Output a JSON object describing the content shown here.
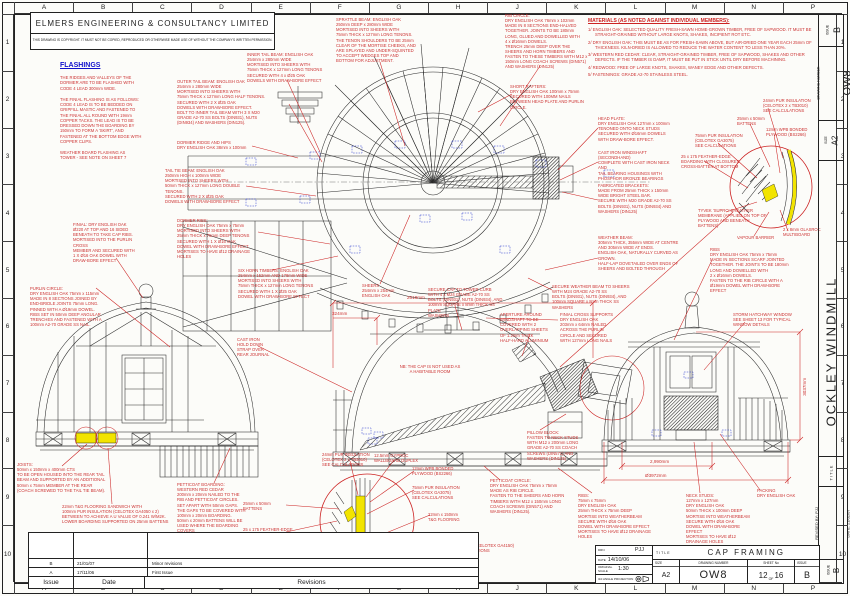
{
  "sheet": {
    "border": {
      "columns": [
        "A",
        "B",
        "C",
        "D",
        "E",
        "F",
        "G",
        "H",
        "J",
        "K",
        "L",
        "M",
        "N",
        "P"
      ],
      "rows": [
        "1",
        "2",
        "3",
        "4",
        "5",
        "6",
        "7",
        "8",
        "9",
        "10"
      ]
    }
  },
  "header": {
    "company": "ELMERS ENGINEERING & CONSULTANCY LIMITED",
    "copyright": "THIS DRAWING IS COPYRIGHT. IT MUST NOT BE COPIED, REPRODUCED OR OTHERWISE MADE USE OF WITHOUT THE COMPANY'S WRITTEN PERMISSION."
  },
  "flashings": {
    "heading": "FLASHINGS",
    "paragraphs": [
      "THE RIDGES AND VALLEYS OF THE\nDORMER ARE TO BE FLASHED WITH\nCODE 4 LEAD 300mm WIDE.",
      "THE FINIAL FLASHING IS AS FOLLOWS:\nCODE 4 LEAD IS TO BE BEDDED ON\nGRIPFILL MASTIC AND FASTENED TO\nTHE FINIAL ALL ROUND WITH 19mm\nCOPPER TACKS. THE LEAD IS TO BE\nDRESSED DOWN THE BOARDING BY\n150mm TO FORM A 'SKIRT', AND\nFASTENED AT THE BOTTOM EDGE WITH\nCOPPER CLIPS.",
      "WEATHER BOARD FLASHING AS\nTOWER - SEE NOTE ON SHEET 7"
    ]
  },
  "materials": {
    "heading": "MATERIALS (AS NOTED AGAINST INDIVIDUAL MEMBERS):",
    "items": [
      "1/  ENGLISH OAK: SELECTED QUALITY FRESH-SAWN HOME-GROWN TIMBER, FREE OF SAPWOOD. IT MUST BE STRAIGHT-GRAINED WITHOUT LARGE KNOTS, SHAKES, INCIPIENT ROT ETC.",
      "2/  DRY ENGLISH OAK: THIS MUST BE AS FOR FRESH-SAWN ABOVE, BUT AIR-DRIED ONE YEAR EACH 25mm OF THICKNESS. KILN-DRIED IS ALLOWED TO REDUCE THE WATER CONTENT TO LESS THAN 20%.",
      "3/  WESTERN RED CEDAR: CLEAR, STRAIGHT-GRAINED TIMBER, FREE OF SAPWOOD, SHAKES AND OTHER DEFECTS. IF THE TIMBER IS DAMP, IT MUST BE PUT IN STICK UNTIL DRY BEFORE MACHINING.",
      "4/  REDWOOD: FREE OF LARGE KNOTS, SHAKES, WANEY EDGE AND OTHER DEFECTS.",
      "5/  FASTENINGS: GRADE A2-70 STAINLESS STEEL."
    ]
  },
  "annotations": [
    {
      "x": 247,
      "y": 52,
      "w": 80,
      "t": "INNER TAIL BEAM: ENGLISH OAK\n254mm x 280mm WIDE\nMORTISED INTO SHEERS WITH\n75mm THICK x 127mm LONG TENONS\nSECURED WITH 4 x Ø25 OAK\nDOWELS WITH DRAW-BORE EFFECT"
    },
    {
      "x": 177,
      "y": 79,
      "w": 112,
      "t": "OUTER TAIL BEAM: ENGLISH OAK\n254mm x 280mm WIDE\nMORTISED INTO SHEERS WITH\n75mm THICK x 127mm LONG HALF TENONS.\nSECURED WITH 2 X Ø25 OAK\nDOWELS WITH DRAW-BORE EFFECT.\nBOLT TO INNER TAIL BEAM WITH 3 X M20\nGRADE A2-70 SS BOLTS (DIN931), NUTS\n(DIN934) AND WASHERS (DIN125)."
    },
    {
      "x": 336,
      "y": 17,
      "w": 88,
      "t": "SPRATTLE BEAM: ENGLISH OAK\n250mm DEEP x 280mm WIDE\nMORTISED INTO SHEERS WITH\n75mm THICK x 127mm LONG TENONS.\nTHE TENON SHOULDERS TO BE 25mm\nCLEAR OF THE MORTISE CHEEKS, AND\nARE SPLAYED AND UNDER-SQUINTED\nTO ACCEPT WEDGES TOP AND\nBOTTOM FOR ADJUSTMENT."
    },
    {
      "x": 505,
      "y": 13,
      "w": 90,
      "t": "RIB CIRCLE:\nDRY ENGLISH OAK 76mm x 102mm\nMADE IN 8 SECTIONS END-HALVED\nTOGETHER. JOINTS TO BE 180mm\nLONG, GLUED AND DOWELLED WITH\n4 x Ø16mm DOWELS.\nTRENCH 25mm DEEP OVER THE\nSHEERS AND HORN TIMBERS AND\nFASTEN TO THESE TIMBERS WITH M12 x\n150mm LONG COACH SCREWS (DIN571)\nAND WASHERS (DIN125)"
    },
    {
      "x": 510,
      "y": 84,
      "w": 78,
      "t": "SHORT RAFTERS:\nDRY ENGLISH OAK 100mm x 75mm\nSECURED WITH 100MM NAILS\nBETWEEN HEAD PLATE AND PURLIN\nCIRCLE."
    },
    {
      "x": 598,
      "y": 116,
      "w": 72,
      "t": "HEAD PLATE:\nDRY ENGLISH OAK 127mm x 100mm\nTENONED ONTO NECK STUDS\nSECURED WITH Ø16mm DOWELS\nWITH DRAW-BORE EFFECT."
    },
    {
      "x": 598,
      "y": 150,
      "w": 80,
      "t": "CAST IRON WINDSHAFT (SECONDHAND)\nCOMPLETE WITH CAST IRON NECK AND\nTAIL BEARING HOUSINGS WITH\nPHOSPHOR BRONZE BEARINGS"
    },
    {
      "x": 598,
      "y": 183,
      "w": 80,
      "t": "FABRICATED BRACKETS:\nMADE FROM 25mm THICK x 150mm\nWIDE BRIGHT STEEL BAR.\nSECURE WITH M20 GRADE A2-70 SS\nBOLTS (DIN931), NUTS (DIN934) AND\nWASHERS (DIN125)"
    },
    {
      "x": 598,
      "y": 235,
      "w": 82,
      "t": "WEATHER BEAM:\n305mm THICK, 355mm WIDE AT CENTRE\nAND 305mm WIDE AT ENDS.\nENGLISH OAK, NATURALLY CURVED AS\nGROWN.\nHALF-LAP DOVETAILED OVER ENDS OF\nSHEERS AND BOLTED THROUGH"
    },
    {
      "x": 552,
      "y": 284,
      "w": 80,
      "t": "SECURE WEATHER BEAM TO SHEERS\nWITH M24 GRADE A2-70 SS\nBOLTS (DIN931), NUTS (DIN934), AND\n100mm SQUARE x 8mm THICK SS\nWASHERS"
    },
    {
      "x": 428,
      "y": 287,
      "w": 78,
      "t": "SECURE CAP TO TOWER CURB\nWITH 4 x M24 GRADE A2-70 SS\nBOLTS (DIN931), NUTS (DIN934), AND\n100mm SQUARE x 8mm THICK SS PLATE\nWASHERS"
    },
    {
      "x": 362,
      "y": 283,
      "w": 45,
      "t": "SHEERS\n254mm x 254mm\nENGLISH OAK"
    },
    {
      "x": 238,
      "y": 268,
      "w": 78,
      "t": "SIX HORN TIMBERS: ENGLISH OAK\n254mm x 152mm AND 178mm WIDE\nMORTISED INTO SHEERS WITH\n75mm THICK x 127mm LONG TENONS\nSECURED WITH 1 X Ø25 OAK\nDOWEL WITH DRAW-BORE EFFECT"
    },
    {
      "x": 177,
      "y": 140,
      "w": 80,
      "t": "DORMER RIDGE AND HIPS\nDRY ENGLISH OAK 38mm x 100mm"
    },
    {
      "x": 165,
      "y": 168,
      "w": 82,
      "t": "TAIL TIE BEAM: ENGLISH OAK\n250mm HIGH x 100mm WIDE\nMORTISED INTO SHEERS WITH\n50mm THICK x 127mm LONG DOUBLE\nTENONS.\nSECURED WITH 2 X Ø25 OAK\nDOWELS WITH DRAW-BORE EFFECT"
    },
    {
      "x": 177,
      "y": 218,
      "w": 82,
      "t": "DORMER RIBS:\nDRY ENGLISH OAK 75mm x 75mm\nMORTISED INTO SHEERS WITH\n25mm THICK x 75mm DEEP TENONS\nSECURED WITH 1 X Ø16 OAK\nDOWEL WITH DRAW-BORE EFFECT.\nMORTISES TO HAVE Ø12 DRAINAGE\nHOLES"
    },
    {
      "x": 73,
      "y": 222,
      "w": 75,
      "t": "FINIAL: DRY ENGLISH OAK\nØ220 AT TOP AND 16 SIDED\nBENEATH TO TAKE CAP RIBS.\nMORTISED INTO THE PURLIN CROSS\nMEMBER AND SECURED WITH\n1 X Ø16 OAK DOWEL WITH\nDRAW-BORE EFFECT"
    },
    {
      "x": 30,
      "y": 286,
      "w": 80,
      "t": "PURLIN CIRCLE:\nDRY ENGLISH OAK 75mm x 115mm\nMADE IN 8 SECTIONS JOINED BY\nEND-BRIDLE JOINTS 75mm LONG.\nPINNED WITH A Ø19mm DOWEL.\nRIBS SET IN 50mm DEEP ANGULAR\nTRENCHES AND FASTENED WITH A\n100mm A2-70 GRADE SS NAIL."
    },
    {
      "x": 237,
      "y": 337,
      "w": 48,
      "t": "CAST IRON\nHOLD DOWN\nSTRAP OVER\nREAR JOURNAL"
    },
    {
      "x": 385,
      "y": 364,
      "w": 90,
      "cls": "ctr",
      "t": "NB: THE CAP IS NOT USED AS\nA HABITABLE ROOM"
    },
    {
      "x": 500,
      "y": 312,
      "w": 62,
      "t": "APERTURE AROUND\nWINDSHAFT TO BE\nCOVERED WITH 2\nOVERLAPPING SHEETS\nOF 1.2mm THICK\nHALF-HARD ALUMINIUM"
    },
    {
      "x": 560,
      "y": 312,
      "w": 70,
      "t": "FINIAL CROSS SUPPORTS\nDRY ENGLISH OAK\n203mm x 64mm NAILED\nACROSS THE PURLIN\nCIRCLE AND SECURED\nWITH 127mm LONG NAILS"
    },
    {
      "x": 527,
      "y": 430,
      "w": 62,
      "t": "PILLOW BLOCK:\nFASTEN TO NECK STUDS\nWITH M12 x 200mm LONG\nGRADE A2-70 SS COACH\nSCREWS (DIN571) AND\nWASHERS (DIN125)"
    },
    {
      "x": 733,
      "y": 312,
      "w": 68,
      "t": "STORM HATCHWAY  WINDOW\nSEE SHEET 13 FOR TYPICAL\nWINDOW DETAILS"
    },
    {
      "x": 710,
      "y": 247,
      "w": 92,
      "t": "RIBS\nDRY ENGLISH OAK 75mm x 75mm\nMADE IN SECTIONS SCARF JOINTED\nTOGETHER. THE JOINTS TO BE 180mm\nLONG AND DOWELLED WITH\n2 x Ø16mm DOWELS.\nFASTEN TO THE RIB CIRCLE WITH A\nØ19mm DOWEL WITH DRAW-BORE\nEFFECT"
    },
    {
      "x": 763,
      "y": 98,
      "w": 58,
      "t": "24mm PUR INSULATION\n(CELOTEX 2 x TB3010)\nSEE CALCULATIONS"
    },
    {
      "x": 737,
      "y": 116,
      "w": 40,
      "t": "25mm x 50mm\nBATTENS"
    },
    {
      "x": 766,
      "y": 127,
      "w": 55,
      "t": "12mm WPB BONDED\nPLYWOOD (BS2266)"
    },
    {
      "x": 695,
      "y": 133,
      "w": 52,
      "t": "75mm PUR INSULATION\n(CELOTEX GA3075)\nSEE CALCULATIONS"
    },
    {
      "x": 681,
      "y": 154,
      "w": 60,
      "t": "25 x 175 FEATHER-EDGE\nBOARDING WITH CLOSURES\nCROSS-BATTEN AT BOTTOM"
    },
    {
      "x": 698,
      "y": 208,
      "w": 72,
      "t": "TYVEK 'SUPRO' BREATHER\nMEMBRANE (APPLIED ON TOP OF\nPLYWOOD AND BENEATH BATTENS)"
    },
    {
      "x": 737,
      "y": 235,
      "w": 45,
      "t": "VAPOUR BARRIER"
    },
    {
      "x": 783,
      "y": 227,
      "w": 42,
      "t": "2 x 8mm GLASROC\nMULTIBOARD"
    },
    {
      "x": 322,
      "y": 452,
      "w": 55,
      "t": "24mm PUR INSULATION\n(CELOTEX 2 x TB3010)\nSEE CALCULATIONS"
    },
    {
      "x": 374,
      "y": 453,
      "w": 50,
      "t": "12.5mm GYPROC\nWALLBOARD DUPLEX"
    },
    {
      "x": 412,
      "y": 466,
      "w": 52,
      "t": "12mm WPB BONDED\nPLYWOOD (BS2266)"
    },
    {
      "x": 412,
      "y": 485,
      "w": 55,
      "t": "75mm PUR INSULATION\n(CELOTEX GA3075)\nSEE CALCULATIONS"
    },
    {
      "x": 428,
      "y": 512,
      "w": 48,
      "t": "22mm x 150mm\nT&G FLOORING"
    },
    {
      "x": 424,
      "y": 543,
      "w": 90,
      "t": "150mm PUR INSULATION (CELOTEX GA4150)\nSEE FLAT ROOF CALCULATIONS"
    },
    {
      "x": 378,
      "y": 566,
      "w": 55,
      "t": "50mm x 75mm BEAM TO\nSUPPORT REAR OF\nFLOOR JOISTS"
    },
    {
      "x": 243,
      "y": 501,
      "w": 42,
      "t": "25mm x 50mm\nBATTENS"
    },
    {
      "x": 243,
      "y": 527,
      "w": 58,
      "t": "25 x 175 FEATHER-EDGE\nBOARDING WITH CLOSURES\nCROSS-BATTEN AT BOTTOM"
    },
    {
      "x": 243,
      "y": 548,
      "w": 62,
      "t": "TYVEK HOUSEWRAP BREATHER\nMEMBRANE (APPLIED ON TOP OF\nPLYWOOD AND BENEATH BATTENS)"
    },
    {
      "x": 17,
      "y": 462,
      "w": 95,
      "t": "JOISTS:\n50mm x 150mm x 400mm CTS\nTO BE OPEN HOUSED INTO THE REAR TAIL\nBEAM AND SUPPORTED BY AN ADDITIONAL\n50mm x 75mm MEMBER AT THE REAR\n(COACH SCREWED TO THE TAIL TIE BEAM)."
    },
    {
      "x": 62,
      "y": 504,
      "w": 110,
      "t": "22mm T&G FLOORING SANDWICH WITH\n100mm PUR INSULATION (CELOTEX GA4050 x 2)\nBETWEEN TO ACHIEVE A U VALUE OF 0.241 W/M2K.\nLOWER BOARDING SUPPORTED ON 25mm BATTENS"
    },
    {
      "x": 177,
      "y": 482,
      "w": 76,
      "t": "PETTICOAT BOARDING:\nWESTERN RED CEDAR\n200mm x 20mm NAILED TO THE\nRIB AND PETTICOAT CIRCLES.\nSET APART WITH 50mm GAPS.\nTHE GAPS TO BE COVERED WITH\n100mm x 20mm BOARDING.\n50mm x 20mm BATTENS WILL BE\nUSED WHERE THE BOARDING COVERS\nTHE WEATHER BEAM AND THE TAIL\nTIE BEAM."
    },
    {
      "x": 490,
      "y": 478,
      "w": 78,
      "t": "PETTICOAT CIRCLE:\nDRY ENGLISH OAK 75mm x 75mm\nMADE AS RIB CIRCLE.\nFASTEN TO THE SHEERS AND HORN\nTIMBERS WITH M12 x 150mm LONG\nCOACH SCREWS (DIN571) AND\nWASHERS (DIN125)."
    },
    {
      "x": 578,
      "y": 493,
      "w": 76,
      "t": "RIBS:\n75mm x 75mm\nDRY ENGLISH OAK\n25mm THICK x 75mm DEEP\nMORTISE INTO WEATHERBEAM\nSECURE WITH Ø16 OAK\nDOWEL WITH DRAW-BORE EFFECT\nMORTISES TO HAVE Ø12 DRAINAGE HOLES"
    },
    {
      "x": 686,
      "y": 493,
      "w": 66,
      "t": "NECK STUDS:\n127mm x 127mm\nDRY ENGLISH OAK\n50mm THICK x 100mm DEEP\nMORTISE INTO WEATHERBEAM\nSECURE WITH Ø16 OAK\nDOWEL WITH DRAW-BORE EFFECT\nMORTISES TO HAVE Ø12 DRAINAGE HOLES"
    },
    {
      "x": 757,
      "y": 488,
      "w": 45,
      "t": "PACKING\nDRY ENGLISH OAK"
    },
    {
      "x": 407,
      "y": 295,
      "w": 40,
      "cls": "dim",
      "t": "2618mm"
    },
    {
      "x": 332,
      "y": 311,
      "w": 30,
      "cls": "dim",
      "t": "324mm"
    },
    {
      "x": 650,
      "y": 459,
      "w": 40,
      "cls": "dim",
      "t": "2,990mm"
    },
    {
      "x": 645,
      "y": 473,
      "w": 45,
      "cls": "dim",
      "t": "Ø3972mm"
    },
    {
      "x": 790,
      "y": 378,
      "w": 30,
      "cls": "dim",
      "rot": -90,
      "t": "3037mm"
    }
  ],
  "title_block": {
    "drn_label": "DRN",
    "drn": "PJJ",
    "date_label": "DATE",
    "date": "14/10/06",
    "scale_label": "ORIGINAL SCALE",
    "scale": "1:30",
    "projection": "3rd ANGLE PROJECTION",
    "title_label": "TITLE",
    "title": "CAP  FRAMING",
    "size_label": "SIZE",
    "size": "A2",
    "drawing_number_label": "DRAWING  NUMBER",
    "drawing_number": "OW8",
    "sheet_label": "SHEET  No",
    "sheet_num": "12",
    "of_label": "OF",
    "sheet_total": "16",
    "issue_label": "ISSUE",
    "issue": "B"
  },
  "side_strip": {
    "project": "OCKLEY  WINDMILL",
    "title_label": "TITLE",
    "revised_by": "REVISED  BY: PJJ",
    "revised_date": "DATE:   21/01/07",
    "issue_label": "ISSUE",
    "issue": "B",
    "size_label": "SIZE",
    "size": "A2",
    "drawing_number_label": "DRAWING  NUMBER",
    "drawing_number": "OW8"
  },
  "revisions": {
    "headers": [
      "Issue",
      "Date",
      "Revisions"
    ],
    "rows": [
      [
        "B",
        "21/01/07",
        "Minor revisions"
      ],
      [
        "A",
        "17/11/06",
        "First Issue"
      ]
    ]
  },
  "colors": {
    "annotation_red": "#cc2222",
    "accent_blue": "#1111cc",
    "highlight_yellow": "#f2e400"
  }
}
